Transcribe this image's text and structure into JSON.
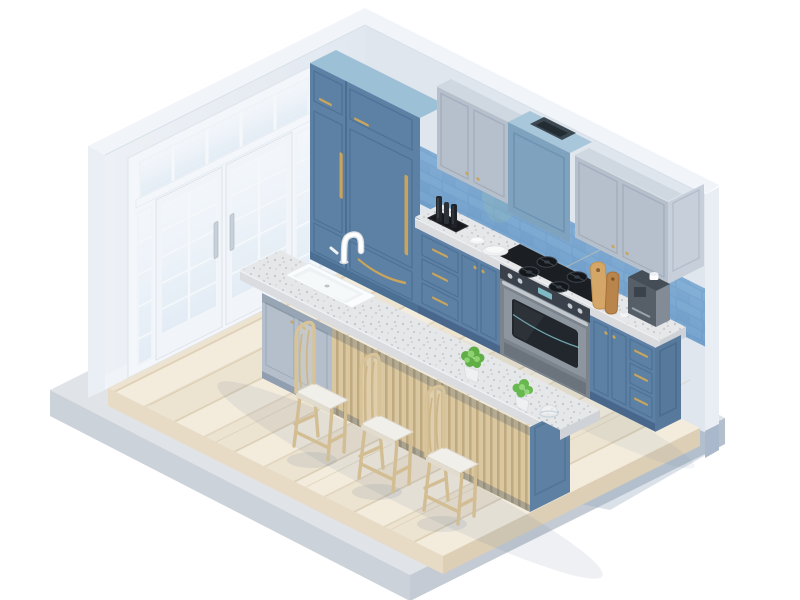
{
  "scene": {
    "title": "Isometric kitchen 3D render",
    "description": "Isometric low-poly 3D render of a kitchen interior with blue shaker cabinetry, a blue subway-tile backsplash, gray upper cabinets, a gas range with oven, a range hood, a tall blue pantry/refrigerator cabinet with brass handles, white French glass doors on the left wall, and a center island with a white farmhouse sink, gooseneck faucet, two potted plants, a slatted wood bar panel and three rattan bar stools, all standing on a light wood plank floor over a gray slab base.",
    "style": "isometric 3D illustration",
    "background": "#ffffff"
  },
  "palette": {
    "wall_white": "#f1f5f9",
    "wall_left": "#e8edf3",
    "wall_right": "#dfe6ee",
    "cabinet_blue": "#5d81a4",
    "cabinet_blue_dark": "#4e7296",
    "cabinet_blue_top": "#9cc0d6",
    "cabinet_gray": "#b6bfcc",
    "hood_blue": "#7fa2bf",
    "tile_blue": "#7ba7cf",
    "grout": "#b8d2e8",
    "granite": "#e6e7e9",
    "brass": "#c9a45c",
    "steel": "#c6ccd2",
    "stove_dark": "#1b1f24",
    "wood_floor": "#efe8d8",
    "slat_wood": "#d9c7a2",
    "stool_wood": "#d8c398",
    "slab_gray": "#dfe3e8",
    "plant_green": "#6cb54d",
    "door_glass": "#e9f0f7"
  },
  "objects": [
    {
      "name": "french-doors",
      "label": "White French glass doors with transom and sidelights"
    },
    {
      "name": "tall-cabinet",
      "label": "Tall blue pantry refrigerator cabinet with brass pulls"
    },
    {
      "name": "upper-cabinets",
      "label": "Gray shaker upper cabinets"
    },
    {
      "name": "range-hood",
      "label": "Blue range hood with top vent"
    },
    {
      "name": "backsplash",
      "label": "Blue subway tile backsplash"
    },
    {
      "name": "gas-range",
      "label": "Gas range with black cooktop and oven"
    },
    {
      "name": "base-cabinets",
      "label": "Blue base cabinets with brass hardware and granite counter"
    },
    {
      "name": "bottle-tray",
      "label": "Black tray with dark glass bottles"
    },
    {
      "name": "plates",
      "label": "Stack of white plates"
    },
    {
      "name": "cutting-boards",
      "label": "Two wooden cutting boards"
    },
    {
      "name": "coffee-machine",
      "label": "Gray coffee machine with white cups"
    },
    {
      "name": "kitchen-island",
      "label": "Island with white farmhouse sink, gooseneck faucet, slat panel"
    },
    {
      "name": "potted-plants",
      "label": "Two green potted plants"
    },
    {
      "name": "bar-stools",
      "label": "Three rattan bar stools with white cushions"
    },
    {
      "name": "wood-floor",
      "label": "Light wood plank floor on gray slab platform"
    }
  ]
}
